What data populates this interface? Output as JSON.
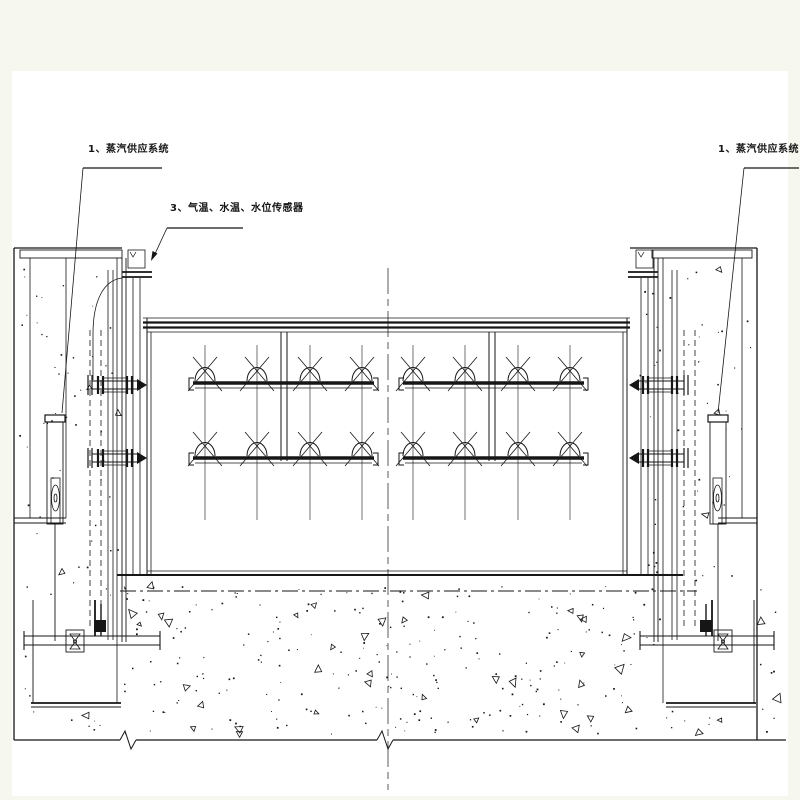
{
  "colors": {
    "background": "#f6f8f0",
    "paper": "#ffffff",
    "line": "#161616"
  },
  "annotations": {
    "left_system_label": "1、蒸汽供应系统",
    "sensor_label": "3、气温、水温、水位传感器",
    "right_system_label": "1、蒸汽供应系统"
  }
}
